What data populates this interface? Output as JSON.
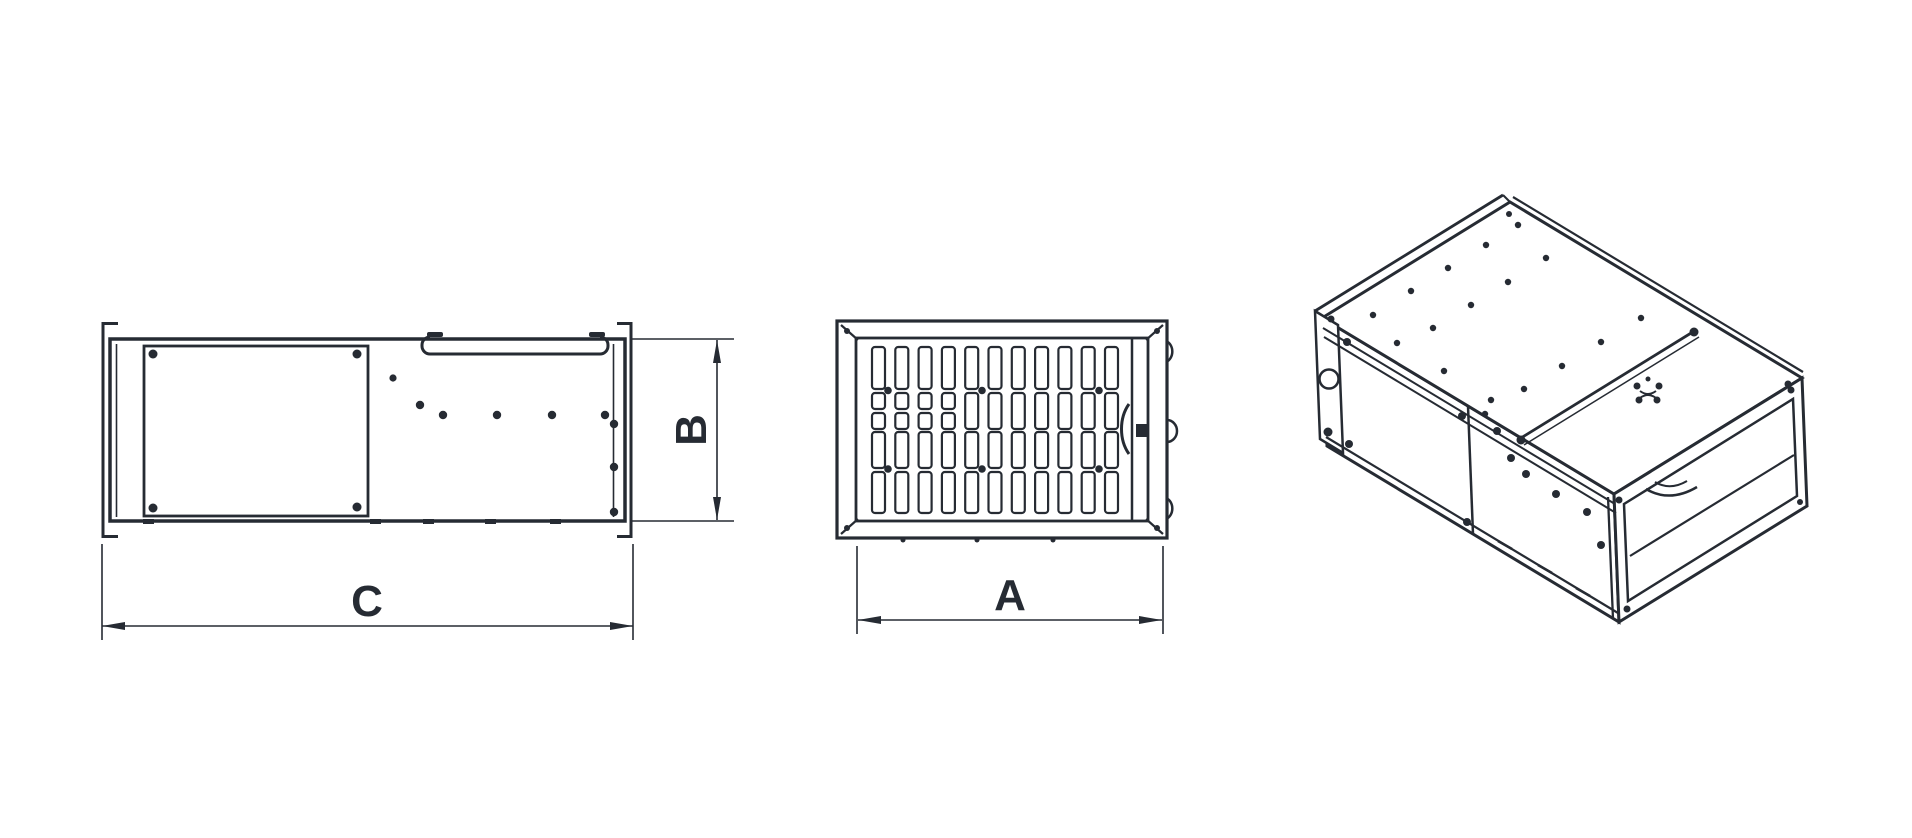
{
  "canvas": {
    "background": "#ffffff",
    "line_color": "#262b33"
  },
  "views": {
    "side": {
      "dim_length_label": "C",
      "dim_height_label": "B"
    },
    "front": {
      "dim_width_label": "A",
      "grille": {
        "columns": 11,
        "x_start": 872,
        "pitch": 23.3,
        "slot_width": 13,
        "corner_radius": 3,
        "rows": [
          {
            "y": 347,
            "h": 42
          },
          {
            "y": 393,
            "h": 36,
            "split": {
              "cols": 4,
              "segments": [
                [
                  393,
                  16
                ],
                [
                  413,
                  16
                ]
              ]
            }
          },
          {
            "y": 432,
            "h": 36
          },
          {
            "y": 472,
            "h": 41
          }
        ]
      }
    }
  }
}
